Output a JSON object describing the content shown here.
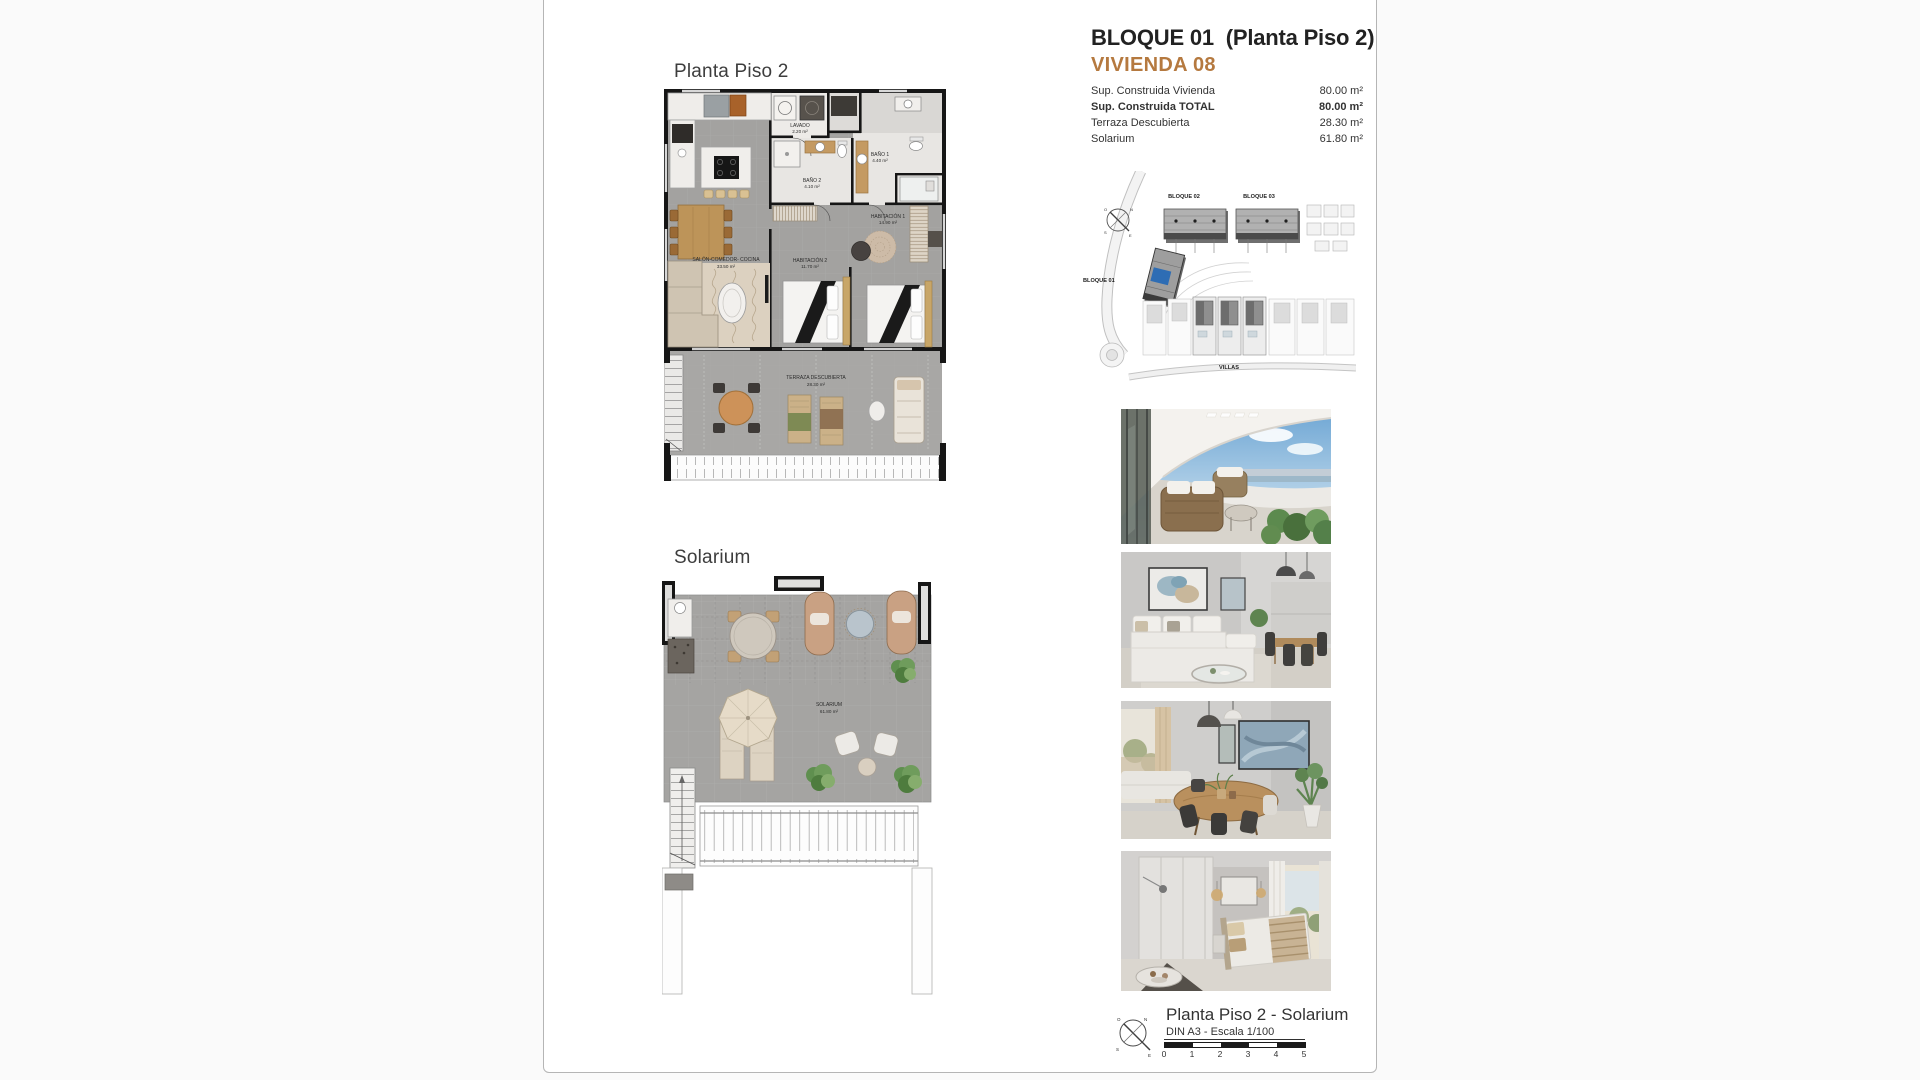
{
  "header": {
    "title": "BLOQUE 01  (Planta Piso 2)",
    "subtitle": "VIVIENDA 08",
    "surface_table": {
      "rows": [
        {
          "label": "Sup. Construida Vivienda",
          "value": "80.00 m²"
        },
        {
          "label": "Sup. Construida TOTAL",
          "value": "80.00 m²"
        },
        {
          "label": "Terraza Descubierta",
          "value": "28.30 m²"
        },
        {
          "label": "Solarium",
          "value": "61.80 m²"
        }
      ]
    }
  },
  "floorplan_piso2": {
    "heading": "Planta Piso 2",
    "rooms": {
      "lavado": {
        "name": "LAVADO",
        "area": "2.20 m²"
      },
      "bano2": {
        "name": "BAÑO 2",
        "area": "4.10 m²"
      },
      "bano1": {
        "name": "BAÑO 1",
        "area": "4.40 m²"
      },
      "habitacion1": {
        "name": "HABITACIÓN 1",
        "area": "14.90 m²"
      },
      "habitacion2": {
        "name": "HABITACIÓN 2",
        "area": "11.70 m²"
      },
      "salon": {
        "name": "SALÓN-COMEDOR- COCINA",
        "area": "33.50 m²"
      },
      "terraza": {
        "name": "TERRAZA DESCUBIERTA",
        "area": "28.30 m²"
      }
    }
  },
  "floorplan_solarium": {
    "heading": "Solarium",
    "rooms": {
      "solarium": {
        "name": "SOLARIUM",
        "area": "61.80 m²"
      }
    }
  },
  "siteplan": {
    "labels": {
      "bloque01": "BLOQUE 01",
      "bloque02": "BLOQUE 02",
      "bloque03": "BLOQUE 03",
      "villas": "VILLAS"
    },
    "highlight_color": "#2e6db4"
  },
  "photos": {
    "items": [
      {
        "name": "terrace-exterior-view"
      },
      {
        "name": "living-room"
      },
      {
        "name": "dining-room"
      },
      {
        "name": "bedroom"
      }
    ]
  },
  "footer": {
    "title": "Planta Piso 2 - Solarium",
    "scale_note": "DIN A3 - Escala 1/100",
    "scale_ticks": [
      "0",
      "1",
      "2",
      "3",
      "4",
      "5"
    ]
  },
  "colors": {
    "accent": "#b5793f",
    "highlight_blue": "#2e6db4",
    "wall": "#161616"
  }
}
